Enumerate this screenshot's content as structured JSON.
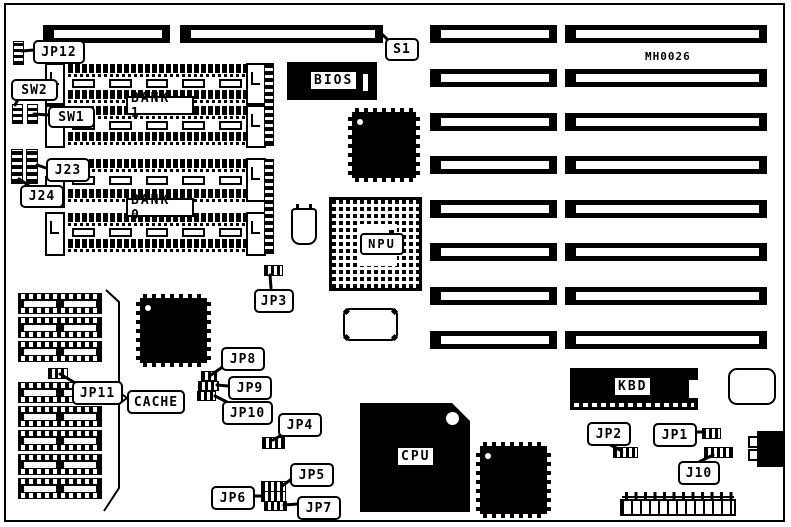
{
  "board": {
    "part_number": "MH0026",
    "chips": {
      "bios": "BIOS",
      "npu": "NPU",
      "cpu": "CPU",
      "kbd": "KBD"
    },
    "memory": {
      "bank1": "BANK 1",
      "bank0": "BANK 0",
      "cache": "CACHE"
    },
    "connectors": {
      "s1": "S1",
      "j10": "J10",
      "j23": "J23",
      "j24": "J24"
    },
    "switches": {
      "sw1": "SW1",
      "sw2": "SW2"
    },
    "jumpers": {
      "jp1": "JP1",
      "jp2": "JP2",
      "jp3": "JP3",
      "jp4": "JP4",
      "jp5": "JP5",
      "jp6": "JP6",
      "jp7": "JP7",
      "jp8": "JP8",
      "jp9": "JP9",
      "jp10": "JP10",
      "jp11": "JP11",
      "jp12": "JP12"
    },
    "colors": {
      "ink": "#000000",
      "paper": "#ffffff"
    }
  }
}
